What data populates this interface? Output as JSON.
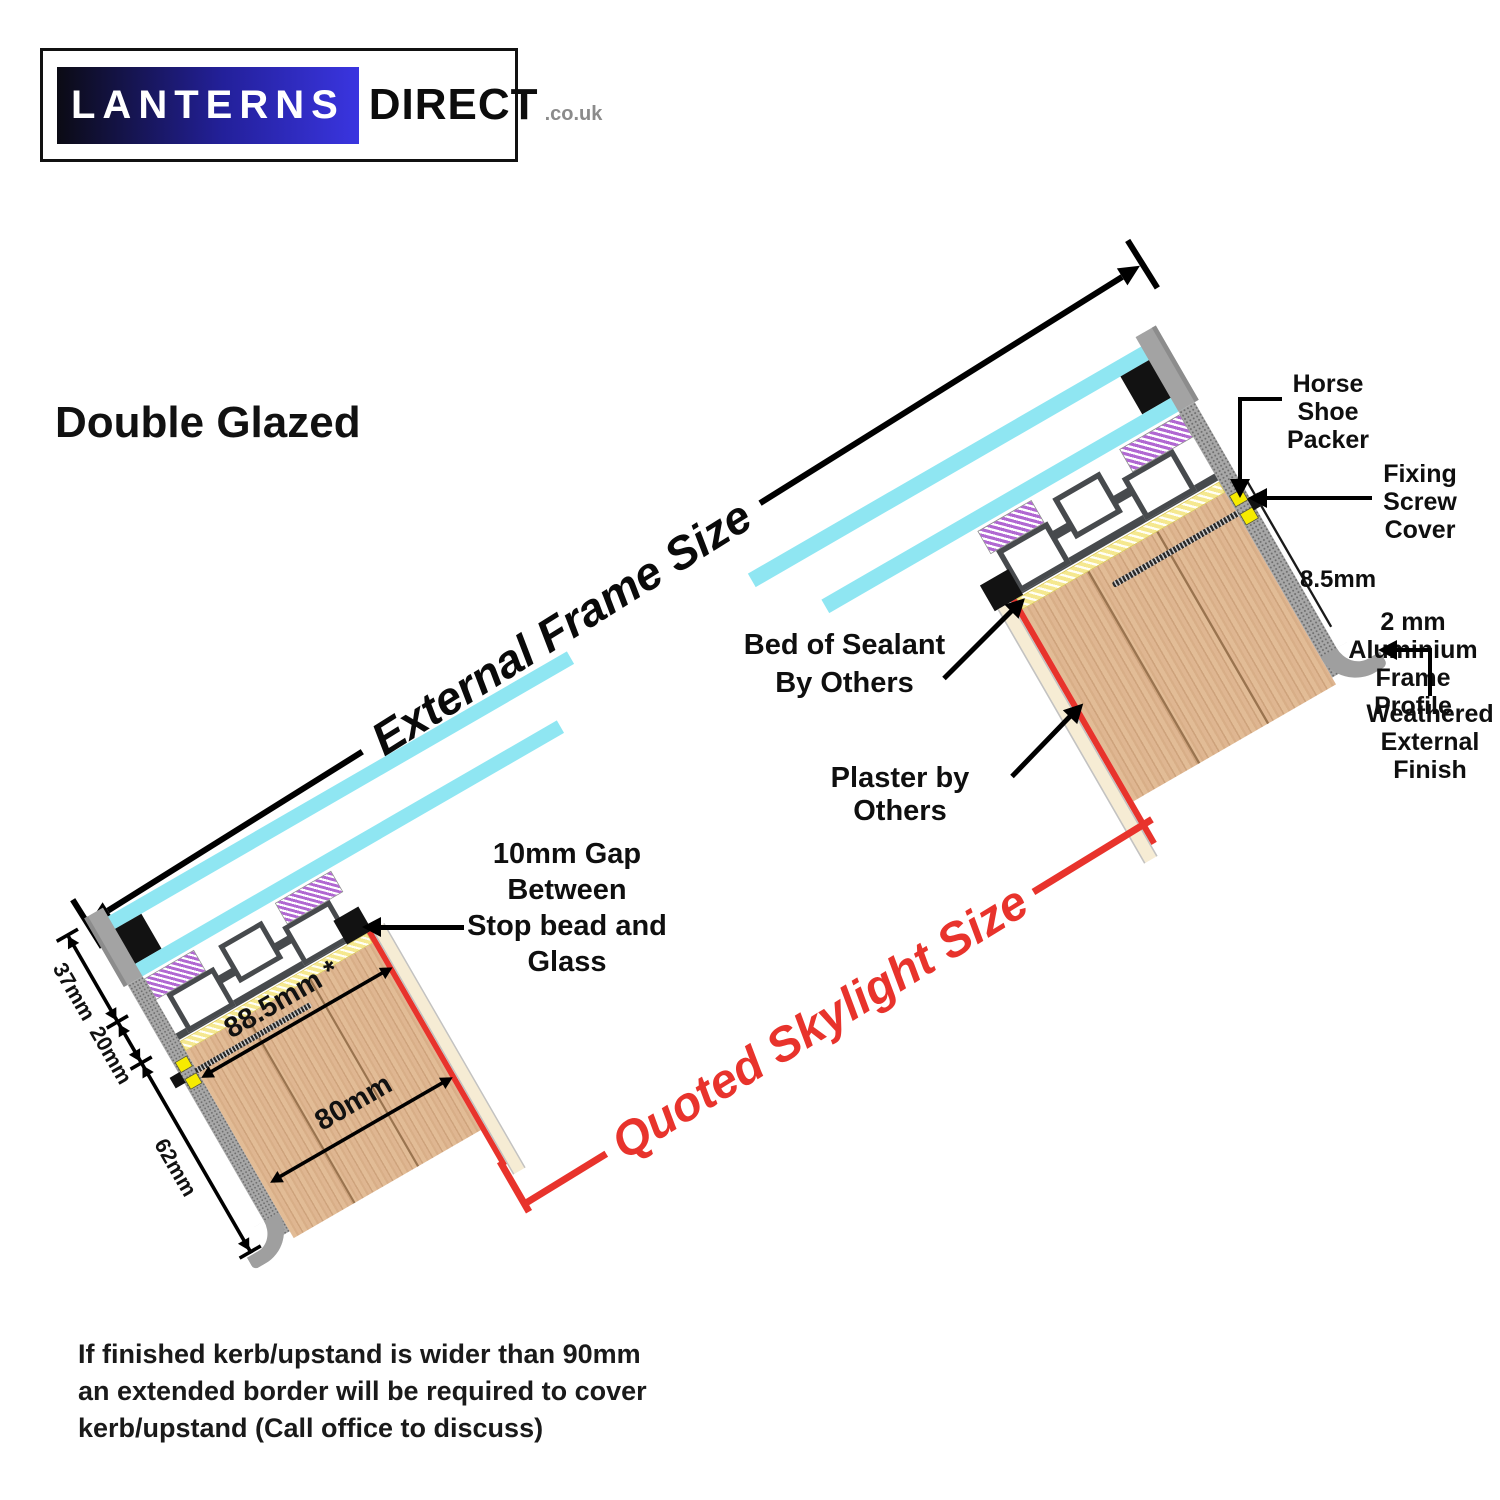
{
  "logo": {
    "brand": "LANTERNS",
    "brand2": "DIRECT",
    "tld": ".co.uk"
  },
  "title": "Double Glazed",
  "diagram": {
    "external_frame_size": "External Frame Size",
    "quoted_skylight_size": "Quoted Skylight Size"
  },
  "annotations": {
    "gap_note": [
      "10mm Gap",
      "Between",
      "Stop bead and",
      "Glass"
    ],
    "bed_of_sealant": [
      "Bed of Sealant",
      "By Others"
    ],
    "plaster_by_others": "Plaster by Others",
    "horse_shoe_packer": [
      "Horse",
      "Shoe",
      "Packer"
    ],
    "fixing_screw_cover": [
      "Fixing",
      "Screw",
      "Cover"
    ],
    "aluminium_profile": [
      "2 mm",
      "Aluminium",
      "Frame Profile"
    ],
    "weathered_finish": [
      "Weathered",
      "External Finish"
    ]
  },
  "dimensions": {
    "glazing_zone": "37mm",
    "frame_lip": "20mm",
    "kerb_depth": "62mm",
    "kerb_width_overall": "88.5mm *",
    "kerb_width_inner": "80mm",
    "screw_cover": "8.5mm"
  },
  "footer": [
    "If finished kerb/upstand is wider than 90mm",
    "an extended border will be required to cover",
    "kerb/upstand (Call office to discuss)"
  ],
  "colors": {
    "brand_blue": "#3A35E0",
    "glass_cyan": "#8FE6F2",
    "highlight_red": "#E8332C",
    "gasket_purple": "#B168D2",
    "packing_yellow": "#F5E88F",
    "packer_yellow": "#F6EB00",
    "timber": "#DFB691",
    "frame_gray": "#474A4D",
    "weathered_gray": "#A3A3A3"
  }
}
